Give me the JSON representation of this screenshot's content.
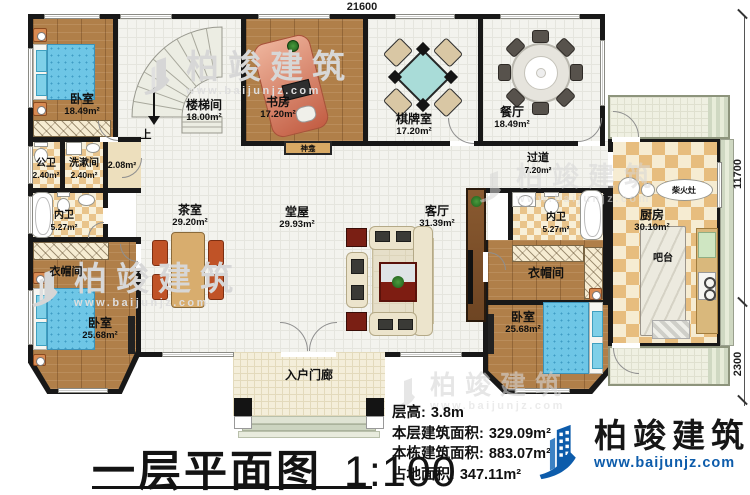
{
  "title": {
    "text": "一层平面图",
    "scale": "1:100"
  },
  "dimensions": {
    "top": "21600",
    "right_upper": "11700",
    "right_lower": "2300"
  },
  "rooms": {
    "bedroom_tl": {
      "name": "卧室",
      "area": "18.49m²"
    },
    "stair": {
      "name": "楼梯间",
      "area": "18.00m²"
    },
    "study": {
      "name": "书房",
      "area": "17.20m²"
    },
    "chess": {
      "name": "棋牌室",
      "area": "17.20m²"
    },
    "dining": {
      "name": "餐厅",
      "area": "18.49m²"
    },
    "pub_bath": {
      "name": "公卫",
      "area": "2.40m²"
    },
    "wash": {
      "name": "洗漱间",
      "area": "2.40m²"
    },
    "hall2": {
      "area": "2.08m²"
    },
    "bath_l": {
      "name": "内卫",
      "area": "5.27m²"
    },
    "cloak_l": {
      "name": "衣帽间"
    },
    "bedroom_bl": {
      "name": "卧室",
      "area": "25.68m²"
    },
    "tea": {
      "name": "茶室",
      "area": "29.20m²"
    },
    "hall": {
      "name": "堂屋",
      "area": "29.93m²"
    },
    "living": {
      "name": "客厅",
      "area": "31.39m²"
    },
    "corridor": {
      "name": "过道",
      "area": "7.20m²"
    },
    "bath_r": {
      "name": "内卫",
      "area": "5.27m²"
    },
    "cloak_r": {
      "name": "衣帽间"
    },
    "bedroom_br": {
      "name": "卧室",
      "area": "25.68m²"
    },
    "kitchen": {
      "name": "厨房",
      "area": "30.10m²"
    },
    "porch": {
      "name": "入户门廊"
    }
  },
  "annotations": {
    "up": "上",
    "shrine": "神龛",
    "wood_stove": "柴火灶",
    "bar": "吧台"
  },
  "stats": {
    "lines": [
      {
        "label": "层高:",
        "value": "3.8m"
      },
      {
        "label": "本层建筑面积:",
        "value": "329.09m²"
      },
      {
        "label": "本栋建筑面积:",
        "value": "883.07m²"
      },
      {
        "label": "占地面积:",
        "value": "347.11m²"
      }
    ]
  },
  "brand": {
    "name": "柏竣建筑",
    "site": "www.baijunjz.com",
    "accent_color": "#0d5cab"
  },
  "watermark": {
    "name": "柏竣建筑",
    "site": "www.baijunjz.com"
  }
}
